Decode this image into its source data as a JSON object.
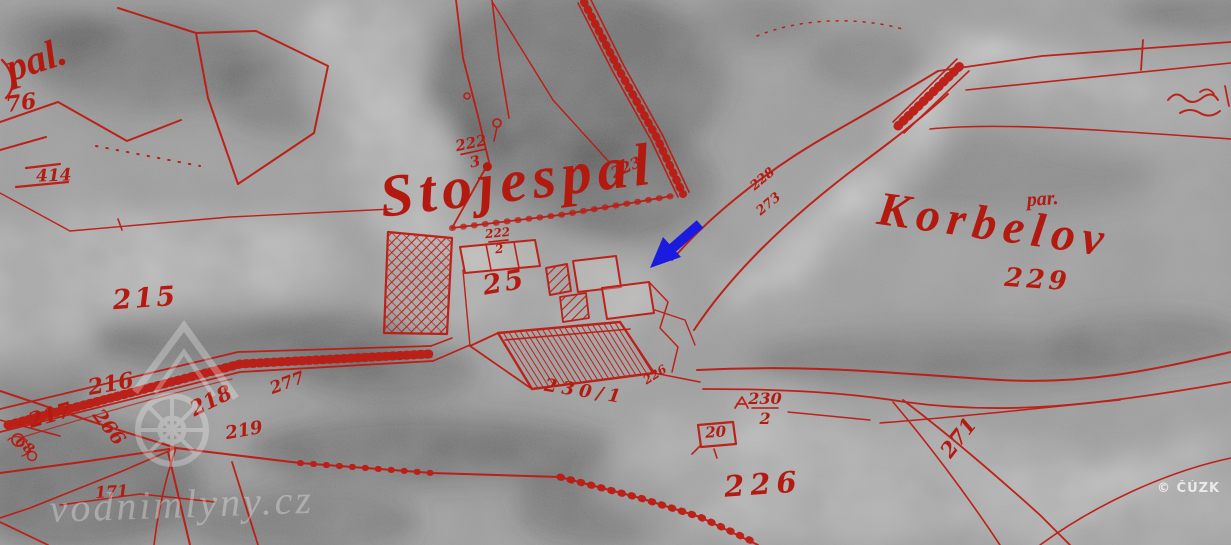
{
  "map": {
    "description": "Historical aerial photograph with red cadastral map overlay and blue location arrow",
    "copyright": "© ČÚZK",
    "watermark": {
      "text": "vodnimlyny.cz",
      "logo": "mill-house-and-water-wheel"
    },
    "colors": {
      "overlay_red": "#bd1a12",
      "label_red": "#b51a10",
      "annotation_blue": "#1b1be0",
      "photo_gray": "#9b9b9b",
      "watermark_white": "#ffffff"
    },
    "annotation_arrow": {
      "meaning": "points to mill site",
      "direction": "down-left",
      "color": "#1b1be0"
    },
    "labels": [
      {
        "name": "place-pal",
        "text": "pal.",
        "x": 40,
        "y": 72,
        "size": 40,
        "rot": -18,
        "style": "script"
      },
      {
        "name": "parcel-76",
        "text": "76",
        "x": 22,
        "y": 110,
        "size": 22,
        "rot": -8,
        "style": "num"
      },
      {
        "name": "parcel-414",
        "text": "414",
        "x": 54,
        "y": 181,
        "size": 17,
        "rot": -2,
        "style": "num"
      },
      {
        "name": "parcel-215",
        "text": "215",
        "x": 146,
        "y": 307,
        "size": 27,
        "rot": -4,
        "style": "num",
        "ls": 3
      },
      {
        "name": "parcel-216",
        "text": "216",
        "x": 112,
        "y": 391,
        "size": 22,
        "rot": -10,
        "style": "num"
      },
      {
        "name": "parcel-217",
        "text": "217",
        "x": 52,
        "y": 422,
        "size": 21,
        "rot": -16,
        "style": "num"
      },
      {
        "name": "parcel-266",
        "text": "266",
        "x": 104,
        "y": 431,
        "size": 19,
        "rot": 52,
        "style": "num"
      },
      {
        "name": "parcel-218",
        "text": "218",
        "x": 214,
        "y": 407,
        "size": 21,
        "rot": -26,
        "style": "num"
      },
      {
        "name": "parcel-219",
        "text": "219",
        "x": 245,
        "y": 436,
        "size": 18,
        "rot": -10,
        "style": "num"
      },
      {
        "name": "parcel-68",
        "text": "68",
        "x": 22,
        "y": 449,
        "size": 14,
        "rot": 38,
        "style": "num"
      },
      {
        "name": "parcel-171",
        "text": "171",
        "x": 112,
        "y": 497,
        "size": 16,
        "rot": -4,
        "style": "num"
      },
      {
        "name": "parcel-277",
        "text": "277",
        "x": 289,
        "y": 388,
        "size": 17,
        "rot": -20,
        "style": "num"
      },
      {
        "name": "place-stojespal",
        "text": "Stojespal",
        "x": 520,
        "y": 200,
        "size": 60,
        "rot": -7,
        "style": "script",
        "ls": 6
      },
      {
        "name": "parcel-222-3",
        "text": "222",
        "den": "3",
        "x": 472,
        "y": 148,
        "size": 15,
        "rot": -12,
        "style": "num"
      },
      {
        "name": "parcel-222-2",
        "text": "222",
        "den": "2",
        "x": 498,
        "y": 237,
        "size": 12,
        "rot": -6,
        "style": "num"
      },
      {
        "name": "parcel-223",
        "text": "223",
        "x": 628,
        "y": 172,
        "size": 15,
        "rot": -24,
        "style": "num"
      },
      {
        "name": "parcel-25",
        "text": "25",
        "x": 506,
        "y": 291,
        "size": 27,
        "rot": -10,
        "style": "num",
        "ls": 3
      },
      {
        "name": "parcel-228",
        "text": "228",
        "x": 765,
        "y": 182,
        "size": 13,
        "rot": -40,
        "style": "num"
      },
      {
        "name": "parcel-273",
        "text": "273",
        "x": 771,
        "y": 207,
        "size": 13,
        "rot": -40,
        "style": "num"
      },
      {
        "name": "place-korbelov",
        "text": "Korbelov",
        "x": 992,
        "y": 240,
        "size": 48,
        "rot": 8,
        "style": "script",
        "ls": 7
      },
      {
        "name": "label-par",
        "text": "par.",
        "x": 1043,
        "y": 205,
        "size": 20,
        "rot": -4,
        "style": "script"
      },
      {
        "name": "parcel-229",
        "text": "229",
        "x": 1037,
        "y": 288,
        "size": 26,
        "rot": 4,
        "style": "num",
        "ls": 4
      },
      {
        "name": "parcel-226-small",
        "text": "226",
        "x": 657,
        "y": 378,
        "size": 12,
        "rot": -32,
        "style": "num"
      },
      {
        "name": "parcel-230-1",
        "text": "230/1",
        "x": 584,
        "y": 397,
        "size": 18,
        "rot": 9,
        "style": "num",
        "ls": 5
      },
      {
        "name": "parcel-230-2",
        "text": "230",
        "den": "2",
        "x": 765,
        "y": 404,
        "size": 16,
        "rot": 0,
        "style": "num"
      },
      {
        "name": "house-20",
        "text": "20",
        "x": 716,
        "y": 437,
        "size": 15,
        "rot": -4,
        "style": "num"
      },
      {
        "name": "parcel-226",
        "text": "226",
        "x": 764,
        "y": 494,
        "size": 29,
        "rot": -4,
        "style": "num",
        "ls": 6
      },
      {
        "name": "parcel-271",
        "text": "271",
        "x": 964,
        "y": 442,
        "size": 21,
        "rot": -52,
        "style": "num"
      }
    ]
  }
}
